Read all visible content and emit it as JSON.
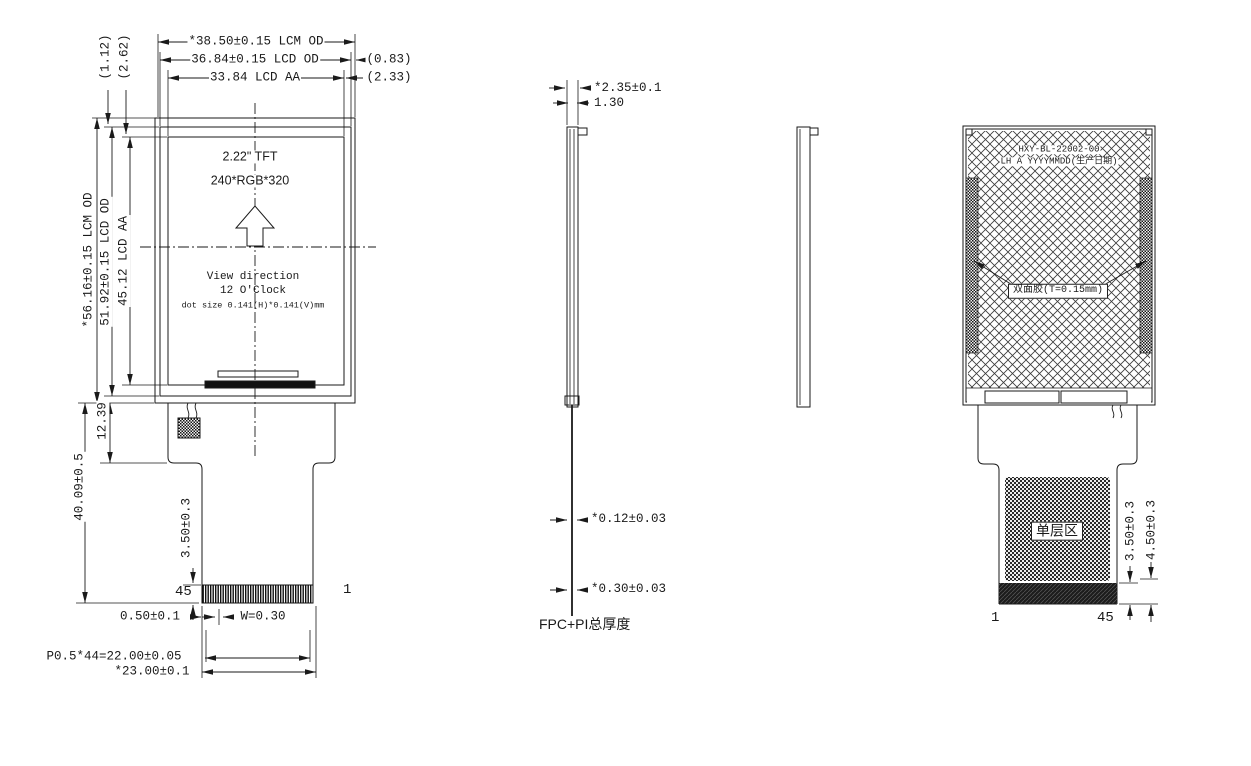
{
  "front": {
    "dims_top": {
      "lcm_od": "*38.50±0.15 LCM OD",
      "lcd_od": "36.84±0.15 LCD OD",
      "lcd_aa": "33.84 LCD AA",
      "gap_lcd": "(0.83)",
      "gap_aa": "(2.33)",
      "vgap_lcd": "(1.12)",
      "vgap_aa": "(2.62)"
    },
    "dims_left": {
      "lcm_od": "*56.16±0.15 LCM OD",
      "lcd_od": "51.92±0.15 LCD OD",
      "lcd_aa": "45.12 LCD AA",
      "fpc_neck": "12.39",
      "fpc_length": "40.09±0.5",
      "finger_depth": "3.50±0.3"
    },
    "screen": {
      "size": "2.22\" TFT",
      "resolution": "240*RGB*320",
      "view_direction_1": "View direction",
      "view_direction_2": "12 O'Clock",
      "dot_size": "dot size 0.141(H)*0.141(V)mm"
    },
    "pins": {
      "left": "45",
      "right": "1"
    },
    "dims_bottom": {
      "edge_margin": "0.50±0.1",
      "pin_width": "W=0.30",
      "pin_pitch": "P0.5*44=22.00±0.05",
      "connector_width": "*23.00±0.1"
    }
  },
  "side": {
    "dims": {
      "module_thickness": "*2.35±0.1",
      "panel_thickness": "1.30",
      "fpc_thickness_1": "*0.12±0.03",
      "fpc_thickness_2": "*0.30±0.03"
    },
    "caption": "FPC+PI总厚度"
  },
  "back": {
    "part_number": "HXY-BL-22002-00",
    "date_code": "LH A YYYYMMDD(生产日期)",
    "adhesive_label": "双面胶(T=0.15mm)",
    "single_layer_label": "单层区",
    "dims": {
      "finger_depth": "3.50±0.3",
      "stiffener_depth": "4.50±0.3"
    },
    "pins": {
      "left": "1",
      "right": "45"
    }
  }
}
